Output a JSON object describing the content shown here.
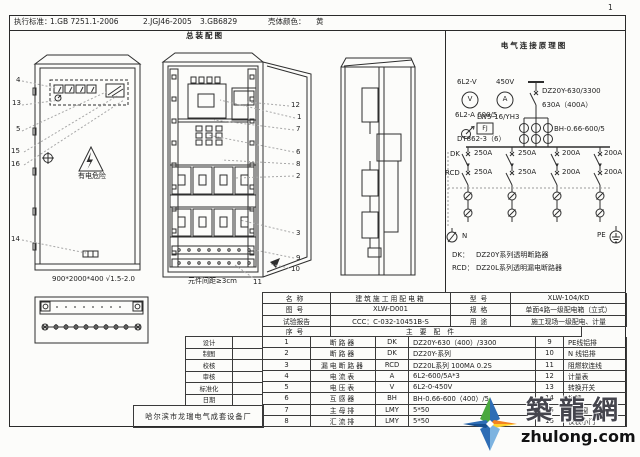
{
  "page": {
    "number": "1"
  },
  "header": {
    "standards_label": "执行标准：",
    "standard_1": "1.GB 7251.1-2006",
    "standard_2": "2.JGJ46-2005",
    "standard_3": "3.GB6829",
    "shell_color_label": "壳体颜色：",
    "shell_color_value": "黄"
  },
  "assembly": {
    "title": "总装配图",
    "front_view": {
      "warning_text": "有电危险",
      "dimension": "900*2000*400 √1.5-2.0",
      "callouts": [
        "4",
        "13",
        "5",
        "15",
        "16",
        "14"
      ]
    },
    "open_view": {
      "callouts": [
        "12",
        "1",
        "7",
        "6",
        "8",
        "2",
        "3",
        "9",
        "10"
      ],
      "spacing_note": "元件间距≥3cm",
      "bottom_callout": "11"
    }
  },
  "schematic": {
    "title": "电气连接原理图",
    "voltmeter_model": "6L2-V",
    "voltage_rating": "450V",
    "voltmeter_symbol": "V",
    "ammeter_symbol": "A",
    "ammeter_model": "6L2-A 600/5",
    "changeover_switch_model": "LW5-16/YH3",
    "fj_label": "FJ",
    "energy_meter_model": "DT862-3（6）",
    "main_breaker_model": "DZ20Y-630/3300",
    "main_breaker_rating": "630A（400A）",
    "ct_model": "BH-0.66-600/5",
    "dk_row_label": "DK",
    "rcd_row_label": "RCD",
    "dk_branch_ratings": [
      "250A",
      "250A",
      "200A",
      "200A"
    ],
    "rcd_branch_ratings": [
      "250A",
      "250A",
      "200A",
      "200A"
    ],
    "n_label": "N",
    "pe_label": "PE",
    "legend": [
      {
        "key": "DK：",
        "value": "DZ20Y系列透明断路器"
      },
      {
        "key": "RCD：",
        "value": "DZ20L系列透明漏电断路器"
      }
    ]
  },
  "title_block": {
    "rows": [
      "设计",
      "制图",
      "校核",
      "审核",
      "标准化",
      "日期"
    ],
    "factory_name": "哈尔滨市龙瑞电气成套设备厂"
  },
  "spec_table": {
    "name_label": "名称",
    "name_value": "建筑施工用配电箱",
    "drawing_no_label": "图号",
    "drawing_no_value": "XLW-D001",
    "test_report_label": "试验报告",
    "test_report_value": "CCC：C-032-10451B-S",
    "model_label": "型号",
    "model_value": "XLW-104/KD",
    "spec_label": "规格",
    "spec_value": "单面4路一级配电箱（立式）",
    "use_label": "用途",
    "use_value": "施工现场一级配电、计量",
    "seq_label": "序号",
    "parts_header": "主要配件",
    "left_rows": [
      {
        "no": "1",
        "name": "断路器",
        "code": "DK",
        "spec": "DZ20Y-630（400）/3300"
      },
      {
        "no": "2",
        "name": "断路器",
        "code": "DK",
        "spec": "DZ20Y-系列"
      },
      {
        "no": "3",
        "name": "漏电断路器",
        "code": "RCD",
        "spec": "DZ20L系列 100MA 0.2S"
      },
      {
        "no": "4",
        "name": "电流表",
        "code": "A",
        "spec": "6L2-600/5A*3"
      },
      {
        "no": "5",
        "name": "电压表",
        "code": "V",
        "spec": "6L2-0-450V"
      },
      {
        "no": "6",
        "name": "互感器",
        "code": "BH",
        "spec": "BH-0.66-600（400）/5"
      },
      {
        "no": "7",
        "name": "主母排",
        "code": "LMY",
        "spec": "5*50"
      },
      {
        "no": "8",
        "name": "汇流排",
        "code": "LMY",
        "spec": "5*50"
      }
    ],
    "right_rows": [
      {
        "no": "9",
        "name": "PE线铝排"
      },
      {
        "no": "10",
        "name": "N 线铝排"
      },
      {
        "no": "11",
        "name": "阻燃软连线"
      },
      {
        "no": "12",
        "name": "计量表"
      },
      {
        "no": "13",
        "name": "转换开关"
      },
      {
        "no": "14",
        "name": "标牌"
      },
      {
        "no": "15",
        "name": "观察窗"
      },
      {
        "no": "16",
        "name": "仪表小门"
      }
    ]
  },
  "watermark": {
    "brand": "築龍網",
    "domain": "zhulong.com"
  }
}
